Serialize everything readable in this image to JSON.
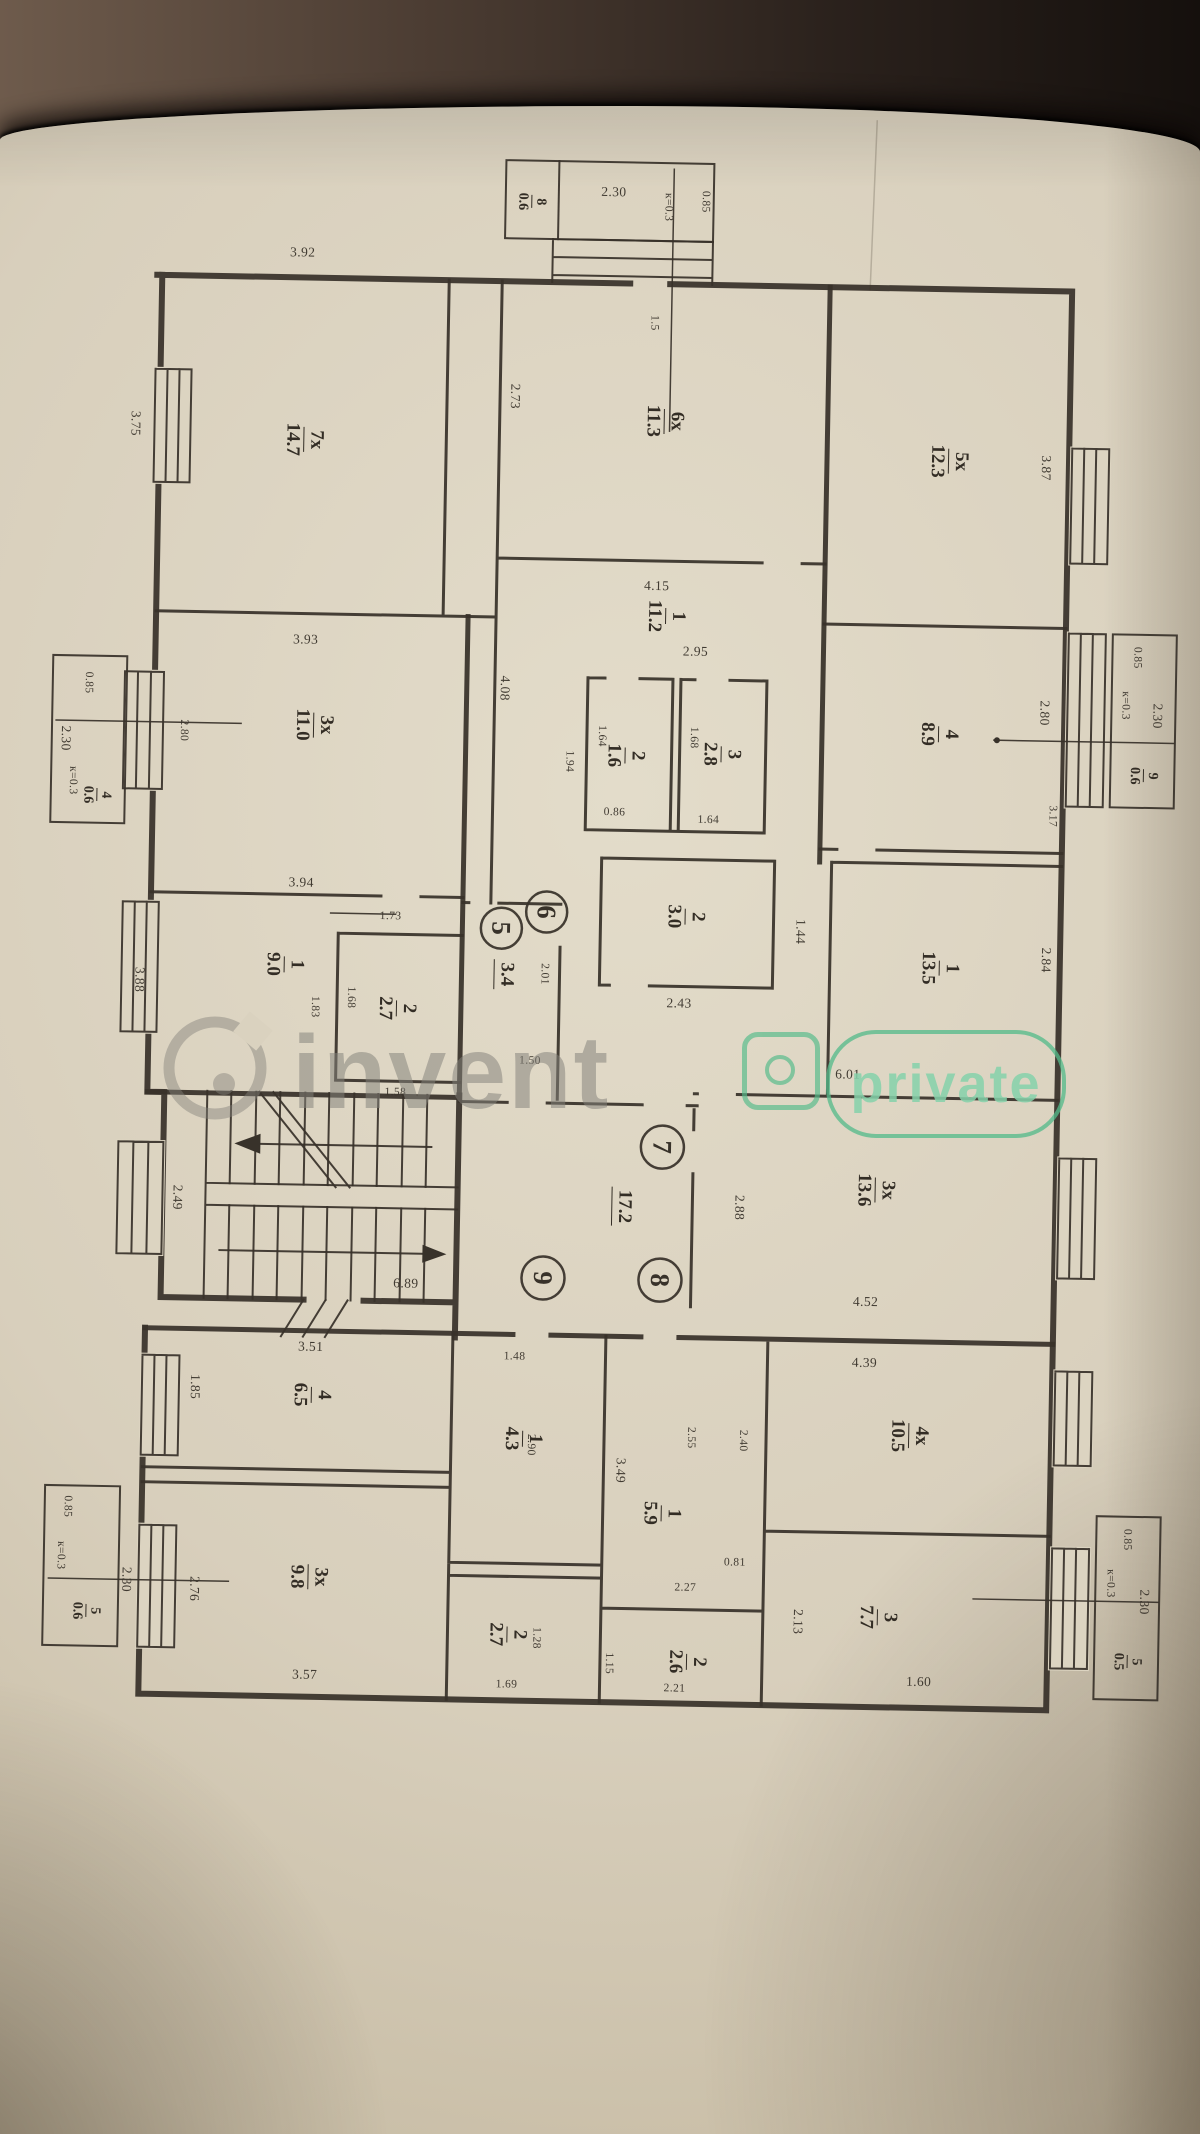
{
  "watermark": {
    "brand": "invent",
    "badge": "private"
  },
  "plan": {
    "apartments": [
      {
        "label": "5"
      },
      {
        "label": "6"
      },
      {
        "label": "7"
      },
      {
        "label": "8"
      },
      {
        "label": "9"
      }
    ],
    "rooms": [
      {
        "n": "7x",
        "a": "14.7",
        "x": 295,
        "y": 445
      },
      {
        "n": "6x",
        "a": "11.3",
        "x": 655,
        "y": 420
      },
      {
        "n": "5x",
        "a": "12.3",
        "x": 940,
        "y": 455
      },
      {
        "n": "1",
        "a": "11.2",
        "x": 660,
        "y": 615
      },
      {
        "n": "2",
        "a": "1.6",
        "x": 622,
        "y": 755
      },
      {
        "n": "3",
        "a": "2.8",
        "x": 718,
        "y": 752
      },
      {
        "n": "4",
        "a": "8.9",
        "x": 935,
        "y": 728
      },
      {
        "n": "3x",
        "a": "11.0",
        "x": 310,
        "y": 730
      },
      {
        "n": "1",
        "a": "9.0",
        "x": 285,
        "y": 970
      },
      {
        "n": "2",
        "a": "2.7",
        "x": 398,
        "y": 1012
      },
      {
        "n": "2",
        "a": "3.0",
        "x": 685,
        "y": 915
      },
      {
        "n": "1",
        "a": "13.5",
        "x": 940,
        "y": 962
      },
      {
        "n": "3x",
        "a": "13.6",
        "x": 880,
        "y": 1185
      },
      {
        "n": "4",
        "a": "6.5",
        "x": 320,
        "y": 1400
      },
      {
        "n": "3x",
        "a": "9.8",
        "x": 320,
        "y": 1582
      },
      {
        "n": "1",
        "a": "4.3",
        "x": 532,
        "y": 1440
      },
      {
        "n": "2",
        "a": "2.7",
        "x": 520,
        "y": 1636
      },
      {
        "n": "1",
        "a": "5.9",
        "x": 672,
        "y": 1512
      },
      {
        "n": "2",
        "a": "2.6",
        "x": 700,
        "y": 1660
      },
      {
        "n": "4x",
        "a": "10.5",
        "x": 918,
        "y": 1430
      },
      {
        "n": "3",
        "a": "7.7",
        "x": 890,
        "y": 1612
      }
    ],
    "area_labels": [
      {
        "t": "3.4",
        "x": 506,
        "y": 976
      },
      {
        "t": "17.2",
        "x": 628,
        "y": 1206
      }
    ],
    "balconies": [
      {
        "n": "8",
        "a": "0.6",
        "x": 518,
        "y": 203
      },
      {
        "n": "9",
        "a": "0.6",
        "x": 1140,
        "y": 766
      },
      {
        "n": "4",
        "a": "0.6",
        "x": 94,
        "y": 804
      },
      {
        "n": "5",
        "a": "0.6",
        "x": 98,
        "y": 1620
      },
      {
        "n": "5",
        "a": "0.5",
        "x": 1140,
        "y": 1652
      }
    ],
    "dims": [
      {
        "t": "3.92",
        "x": 290,
        "y": 258
      },
      {
        "t": "3.75",
        "x": 126,
        "y": 432,
        "v": 1
      },
      {
        "t": "2.73",
        "x": 505,
        "y": 398,
        "v": 1
      },
      {
        "t": "3.87",
        "x": 1037,
        "y": 460,
        "v": 1
      },
      {
        "t": "4.15",
        "x": 650,
        "y": 585
      },
      {
        "t": "2.95",
        "x": 690,
        "y": 650
      },
      {
        "t": "4.08",
        "x": 500,
        "y": 690,
        "v": 1
      },
      {
        "t": "1.94",
        "x": 566,
        "y": 762,
        "v": 1,
        "s": 1
      },
      {
        "t": "1.64",
        "x": 598,
        "y": 736,
        "v": 1,
        "s": 1
      },
      {
        "t": "0.86",
        "x": 612,
        "y": 812,
        "s": 1
      },
      {
        "t": "1.68",
        "x": 690,
        "y": 736,
        "v": 1,
        "s": 1
      },
      {
        "t": "1.64",
        "x": 706,
        "y": 818,
        "s": 1
      },
      {
        "t": "2.80",
        "x": 1040,
        "y": 705,
        "v": 1
      },
      {
        "t": "3.17",
        "x": 1050,
        "y": 808,
        "v": 1,
        "s": 1
      },
      {
        "t": "3.93",
        "x": 300,
        "y": 645
      },
      {
        "t": "2.80",
        "x": 180,
        "y": 738,
        "v": 1,
        "s": 1
      },
      {
        "t": "3.94",
        "x": 300,
        "y": 888
      },
      {
        "t": "3.88",
        "x": 140,
        "y": 988,
        "v": 1
      },
      {
        "t": "1.73",
        "x": 390,
        "y": 920,
        "s": 1
      },
      {
        "t": "1.83",
        "x": 316,
        "y": 1012,
        "v": 1,
        "s": 1
      },
      {
        "t": "1.68",
        "x": 352,
        "y": 1002,
        "v": 1,
        "s": 1
      },
      {
        "t": "1.58",
        "x": 398,
        "y": 1096,
        "s": 1
      },
      {
        "t": "2.01",
        "x": 545,
        "y": 975,
        "v": 1,
        "s": 1
      },
      {
        "t": "1.50",
        "x": 532,
        "y": 1062,
        "s": 1
      },
      {
        "t": "2.43",
        "x": 680,
        "y": 1002
      },
      {
        "t": "1.44",
        "x": 800,
        "y": 928,
        "v": 1
      },
      {
        "t": "2.84",
        "x": 1046,
        "y": 952,
        "v": 1
      },
      {
        "t": "6.01",
        "x": 850,
        "y": 1070
      },
      {
        "t": "2.49",
        "x": 182,
        "y": 1205,
        "v": 1
      },
      {
        "t": "6.89",
        "x": 412,
        "y": 1287
      },
      {
        "t": "2.88",
        "x": 744,
        "y": 1205,
        "v": 1
      },
      {
        "t": "4.52",
        "x": 872,
        "y": 1297
      },
      {
        "t": "3.51",
        "x": 318,
        "y": 1352
      },
      {
        "t": "1.85",
        "x": 203,
        "y": 1394,
        "v": 1
      },
      {
        "t": "2.76",
        "x": 206,
        "y": 1596,
        "v": 1
      },
      {
        "t": "3.57",
        "x": 318,
        "y": 1680
      },
      {
        "t": "1.48",
        "x": 522,
        "y": 1358,
        "s": 1
      },
      {
        "t": "2.90",
        "x": 540,
        "y": 1446,
        "v": 1,
        "s": 1
      },
      {
        "t": "1.28",
        "x": 549,
        "y": 1639,
        "v": 1,
        "s": 1
      },
      {
        "t": "1.69",
        "x": 520,
        "y": 1686,
        "s": 1
      },
      {
        "t": "3.49",
        "x": 630,
        "y": 1470,
        "v": 1
      },
      {
        "t": "2.55",
        "x": 700,
        "y": 1436,
        "v": 1,
        "s": 1
      },
      {
        "t": "2.40",
        "x": 752,
        "y": 1438,
        "v": 1,
        "s": 1
      },
      {
        "t": "2.27",
        "x": 697,
        "y": 1586,
        "s": 1
      },
      {
        "t": "0.81",
        "x": 746,
        "y": 1560,
        "s": 1
      },
      {
        "t": "1.15",
        "x": 622,
        "y": 1663,
        "v": 1,
        "s": 1
      },
      {
        "t": "2.21",
        "x": 688,
        "y": 1687,
        "s": 1
      },
      {
        "t": "4.39",
        "x": 872,
        "y": 1358
      },
      {
        "t": "2.13",
        "x": 810,
        "y": 1618,
        "v": 1
      },
      {
        "t": "1.60",
        "x": 932,
        "y": 1676
      },
      {
        "t": "1.5",
        "x": 643,
        "y": 322,
        "v": 1,
        "s": 1
      },
      {
        "t": "2.30",
        "x": 600,
        "y": 192
      },
      {
        "t": "0.85",
        "x": 692,
        "y": 200,
        "v": 1,
        "s": 1
      },
      {
        "t": "к=0.3",
        "x": 655,
        "y": 206,
        "v": 1,
        "s": 1
      },
      {
        "t": "0.85",
        "x": 1132,
        "y": 648,
        "v": 1,
        "s": 1
      },
      {
        "t": "к=0.3",
        "x": 1121,
        "y": 696,
        "v": 1,
        "s": 1
      },
      {
        "t": "2.30",
        "x": 1153,
        "y": 706,
        "v": 1
      },
      {
        "t": "0.85",
        "x": 84,
        "y": 692,
        "v": 1,
        "s": 1
      },
      {
        "t": "2.30",
        "x": 62,
        "y": 748,
        "v": 1
      },
      {
        "t": "к=0.3",
        "x": 70,
        "y": 790,
        "v": 1,
        "s": 1
      },
      {
        "t": "0.85",
        "x": 78,
        "y": 1516,
        "v": 1,
        "s": 1
      },
      {
        "t": "2.30",
        "x": 138,
        "y": 1588,
        "v": 1
      },
      {
        "t": "к=0.3",
        "x": 72,
        "y": 1565,
        "v": 1,
        "s": 1
      },
      {
        "t": "0.85",
        "x": 1138,
        "y": 1530,
        "v": 1,
        "s": 1
      },
      {
        "t": "к=0.3",
        "x": 1122,
        "y": 1574,
        "v": 1,
        "s": 1
      },
      {
        "t": "2.30",
        "x": 1156,
        "y": 1592,
        "v": 1
      }
    ]
  }
}
